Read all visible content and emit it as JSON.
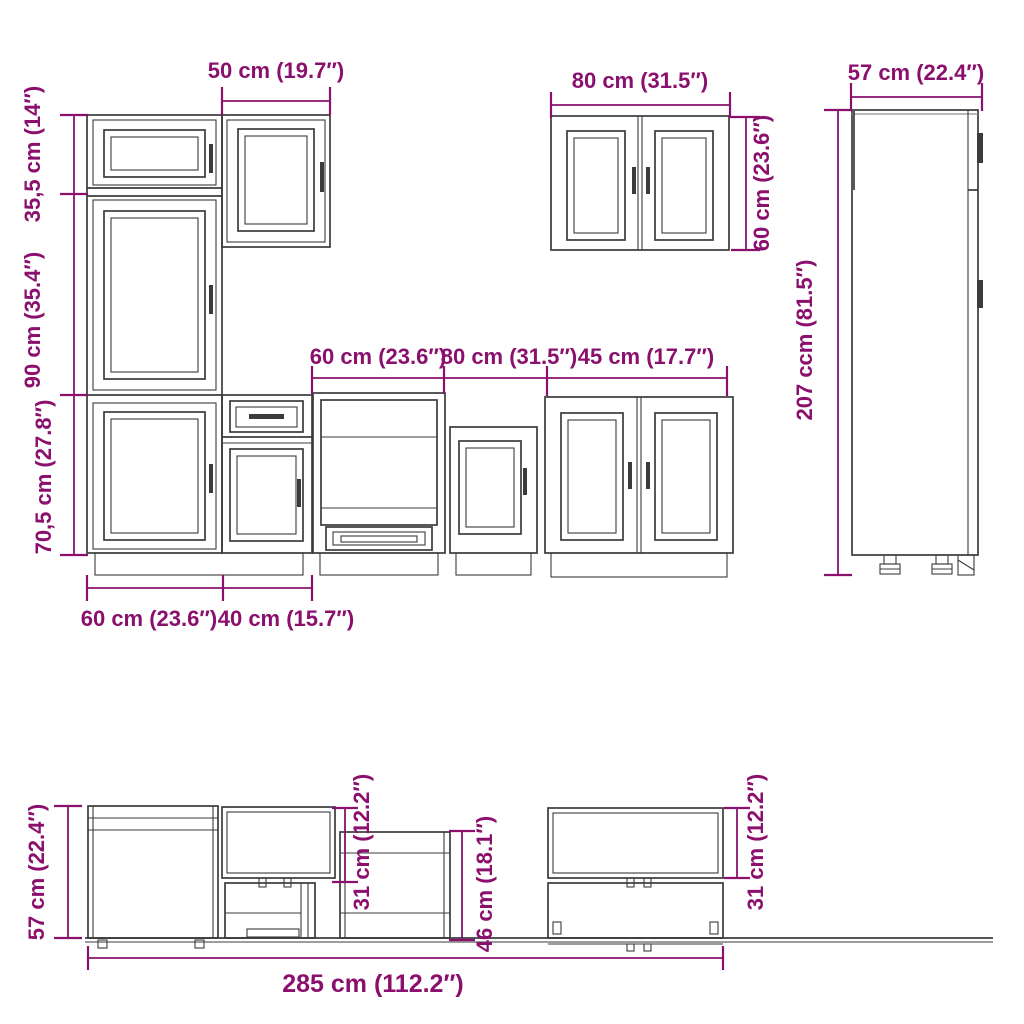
{
  "colors": {
    "dimension": "#8B106E",
    "line": "#3B3B3B",
    "background": "#FFFFFF"
  },
  "units": {
    "metric": "cm",
    "imperial": "inches"
  },
  "dims": {
    "wall50_width": "50 cm (19.7″)",
    "tall_top_section_height": "35,5 cm (14″)",
    "tall_mid_section_height": "90 cm (35.4″)",
    "tall_bottom_section_height": "70,5 cm (27.8″)",
    "row_oven_width": "60 cm (23.6″)",
    "row_sink_width": "80 cm (31.5″)",
    "row_double_width": "45 cm (17.7″)",
    "wall80_width": "80 cm (31.5″)",
    "wall80_height": "60 cm (23.6″)",
    "tall207_depth": "57 cm (22.4″)",
    "tall207_height": "207 ccm (81.5″)",
    "bottom_left_unit_width": "60 cm (23.6″)",
    "bottom_base40_width": "40 cm (15.7″)",
    "side_base_height": "57 cm (22.4″)",
    "side_wall_left_depth": "31 cm (12.2″)",
    "side_oven_height": "46 cm (18.1″)",
    "side_wall_right_depth": "31 cm (12.2″)",
    "total_width": "285 cm (112.2″)"
  }
}
